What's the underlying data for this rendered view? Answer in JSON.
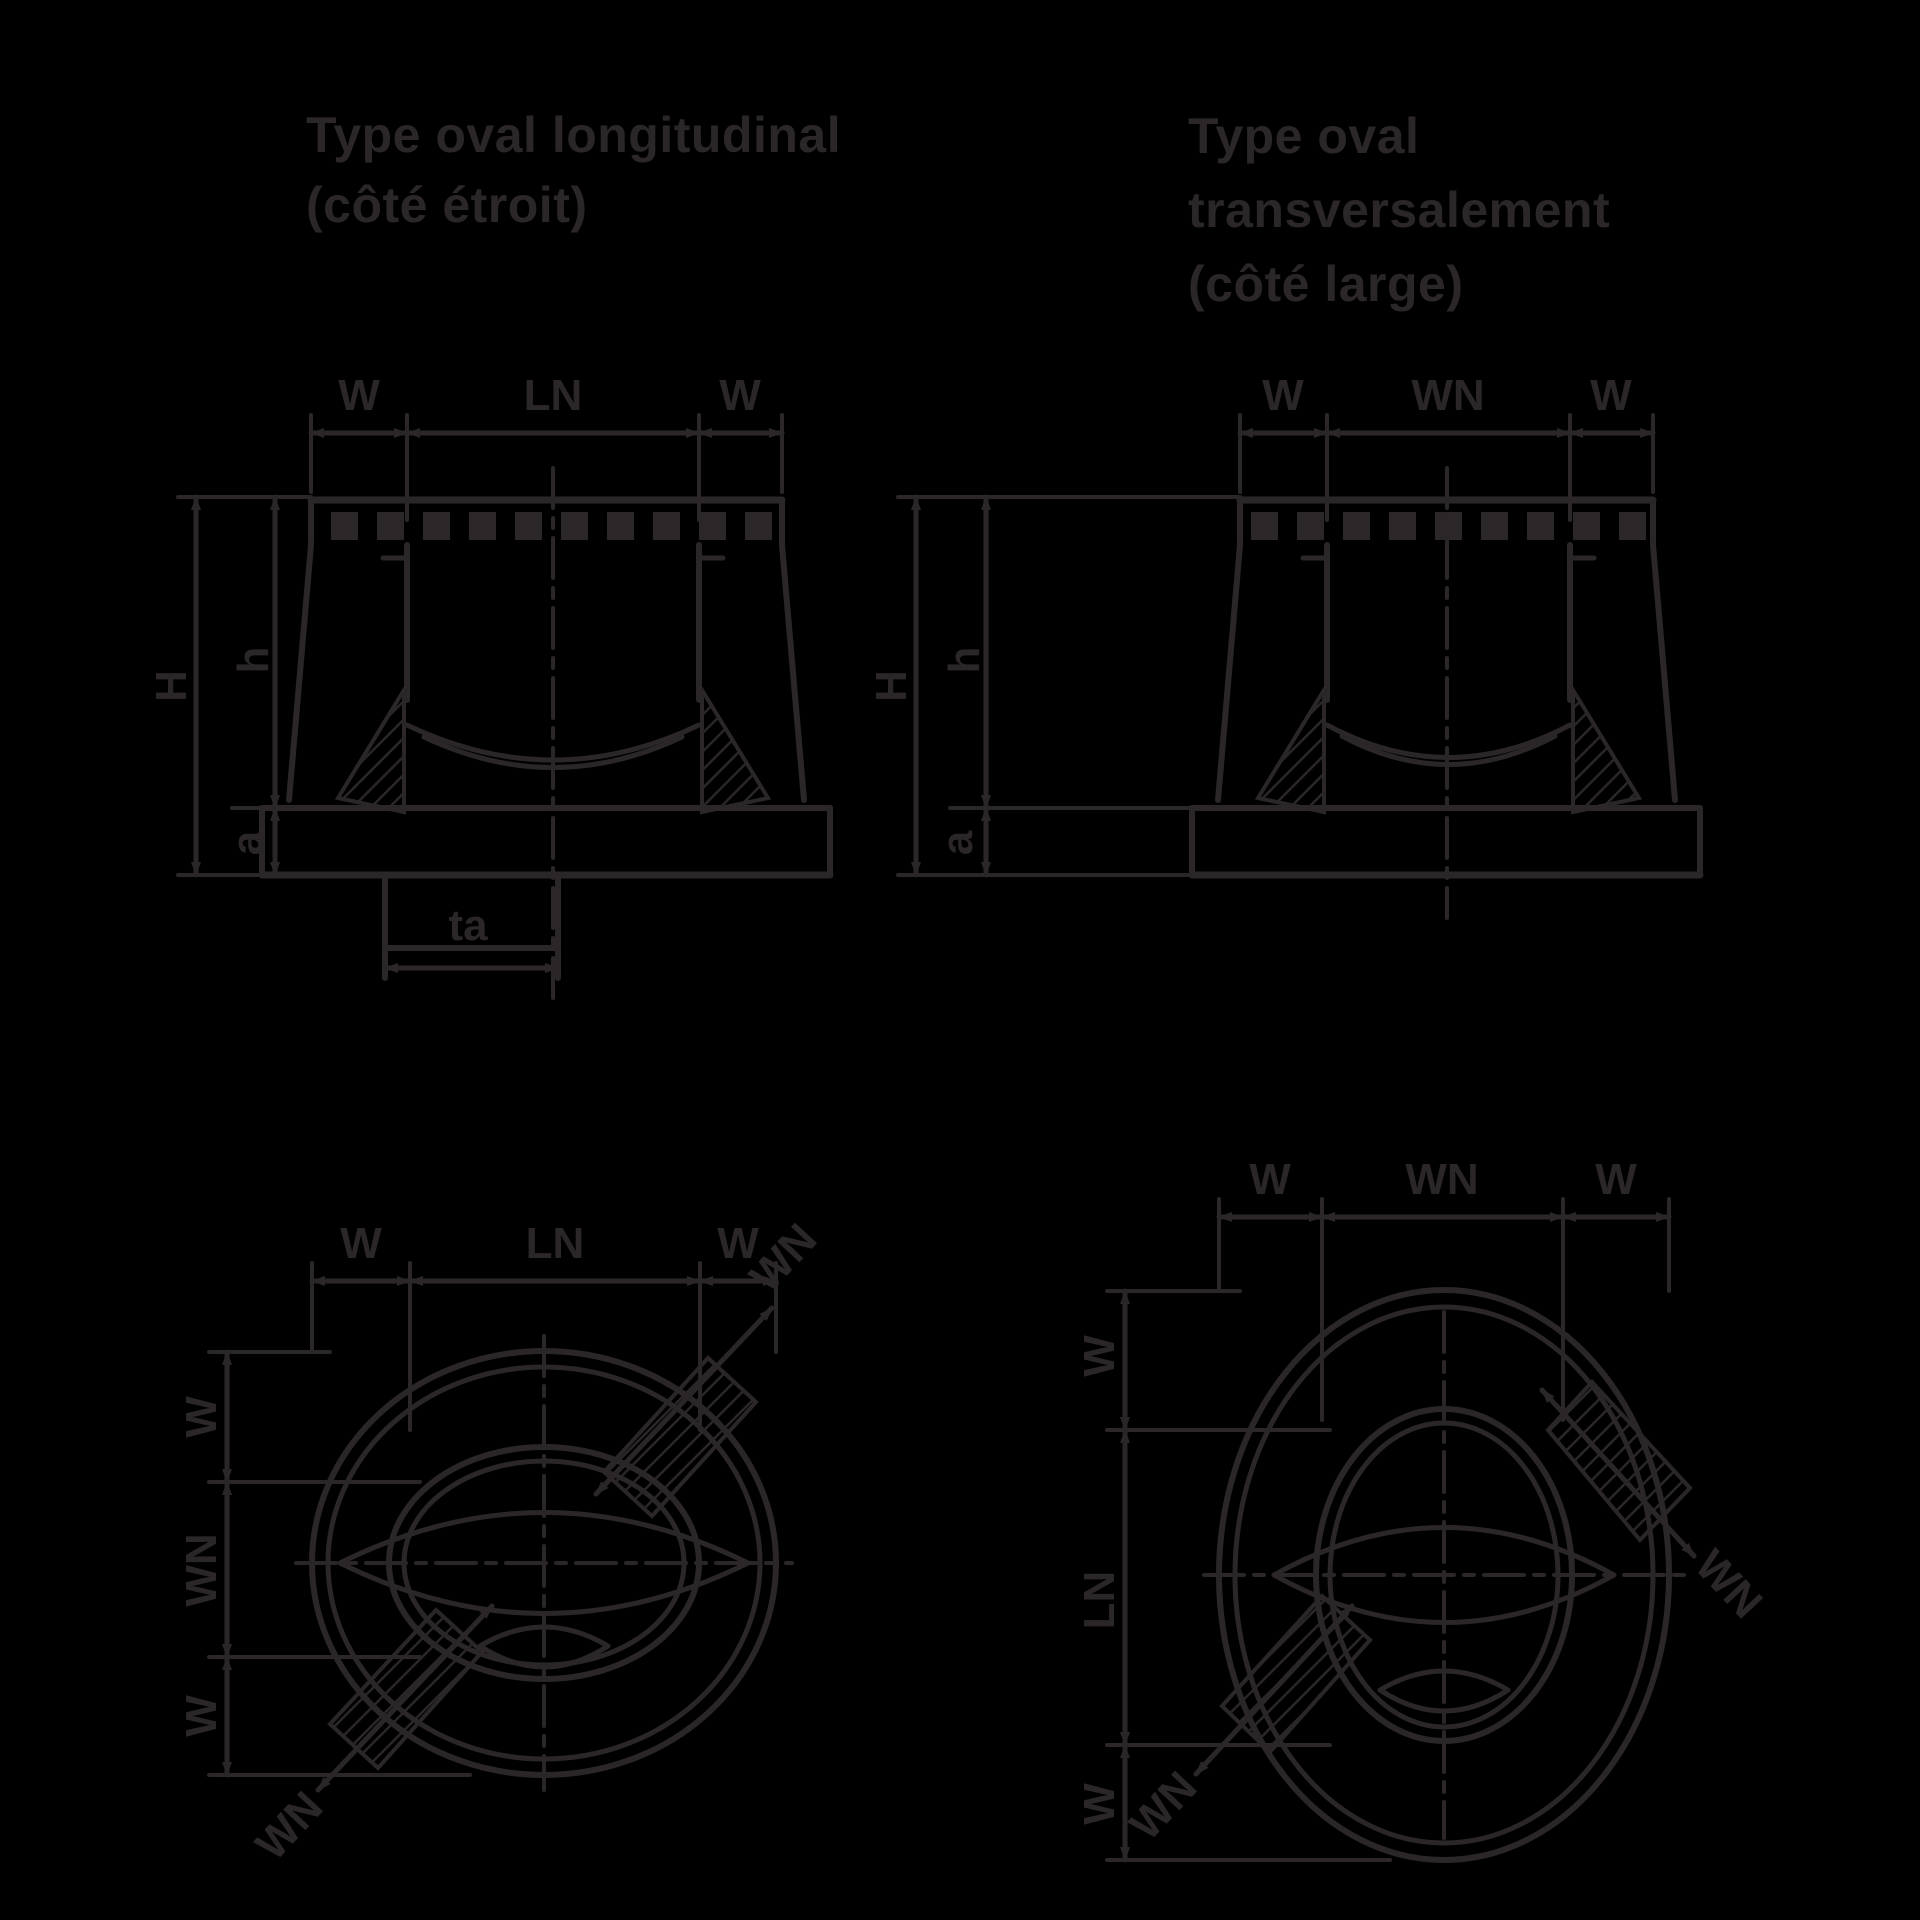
{
  "colors": {
    "background": "#000000",
    "ink": "#2b2728"
  },
  "titles": {
    "left": {
      "line1": "Type oval longitudinal",
      "line2": "(côté étroit)"
    },
    "right": {
      "line1": "Type oval",
      "line2": "transversalement",
      "line3": "(côté large)"
    }
  },
  "section_longitudinal": {
    "dim_top_left": "W",
    "dim_top_center": "LN",
    "dim_top_right": "W",
    "dim_height_outer": "H",
    "dim_height_inner": "h",
    "dim_flange_thickness": "a",
    "dim_spigot": "ta"
  },
  "section_transversal": {
    "dim_top_left": "W",
    "dim_top_center": "WN",
    "dim_top_right": "W",
    "dim_height_outer": "H",
    "dim_height_inner": "h",
    "dim_flange_thickness": "a"
  },
  "plan_longitudinal": {
    "dim_top_left": "W",
    "dim_top_center": "LN",
    "dim_top_right": "W",
    "dim_left_top": "W",
    "dim_left_center": "WN",
    "dim_left_bottom": "W",
    "dim_diag_lower_left": "WN",
    "dim_diag_upper_right": "WN"
  },
  "plan_transversal": {
    "dim_top_left": "W",
    "dim_top_center": "WN",
    "dim_top_right": "W",
    "dim_left_top": "W",
    "dim_left_center": "LN",
    "dim_left_bottom": "W",
    "dim_diag_lower_left": "WN",
    "dim_diag_lower_right": "WN"
  }
}
